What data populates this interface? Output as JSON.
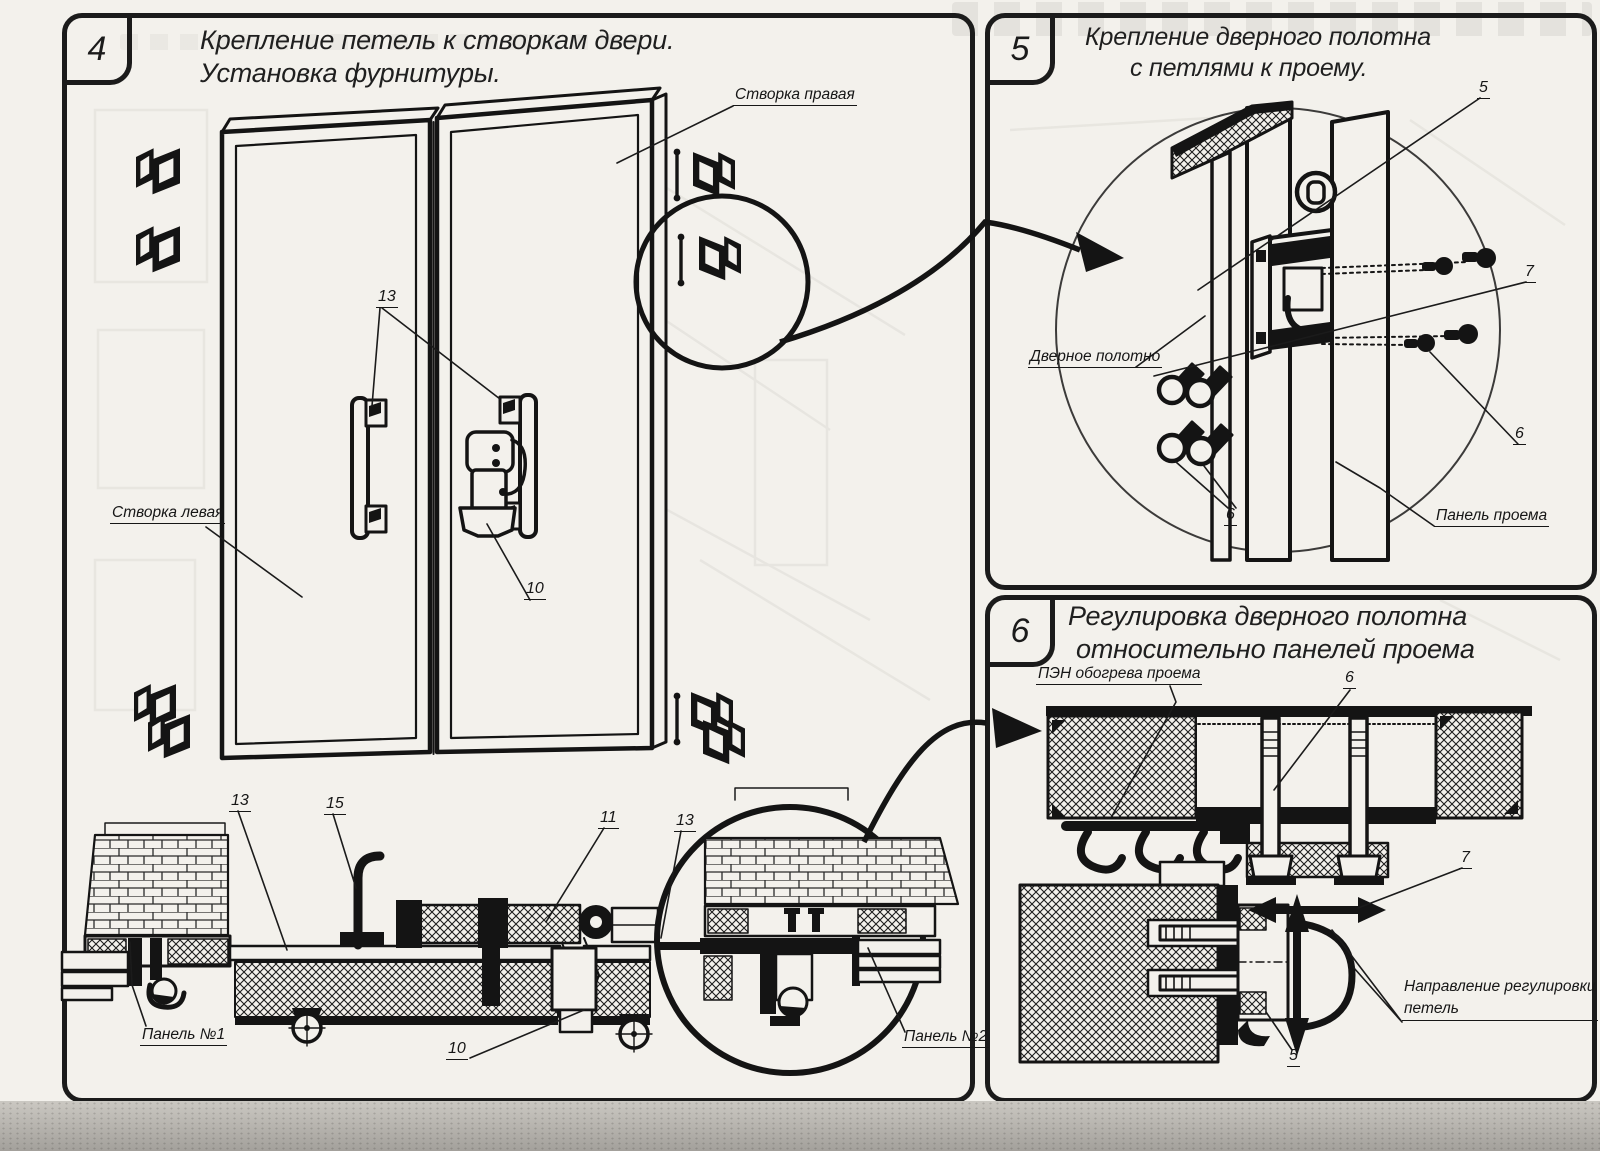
{
  "colors": {
    "ink": "#1b1b1b",
    "paper": "#f3f1ec"
  },
  "panel4": {
    "number": "4",
    "title_line1": "Крепление петель к створкам двери.",
    "title_line2": "Установка фурнитуры.",
    "labels": {
      "right_leaf": "Створка правая",
      "left_leaf": "Створка левая",
      "panel1": "Панель №1",
      "panel2": "Панель №2"
    },
    "callouts": {
      "c13_handles": "13",
      "c10_latch": "10",
      "c13_left": "13",
      "c15": "15",
      "c11": "11",
      "c13_right": "13",
      "c10_bottom": "10"
    }
  },
  "panel5": {
    "number": "5",
    "title_line1": "Крепление дверного полотна",
    "title_line2": "с петлями к проему.",
    "labels": {
      "door_leaf": "Дверное полотно",
      "opening_panel": "Панель проема"
    },
    "callouts": {
      "c5": "5",
      "c7": "7",
      "c6_screws_right": "6",
      "c6_screws_left": "6"
    }
  },
  "panel6": {
    "number": "6",
    "title_line1": "Регулировка дверного полотна",
    "title_line2": "относительно панелей проема",
    "labels": {
      "heater": "ПЭН обогрева проема",
      "direction_line1": "Направление регулировки",
      "direction_line2": "петель"
    },
    "callouts": {
      "c6": "6",
      "c7": "7",
      "c5": "5"
    }
  }
}
